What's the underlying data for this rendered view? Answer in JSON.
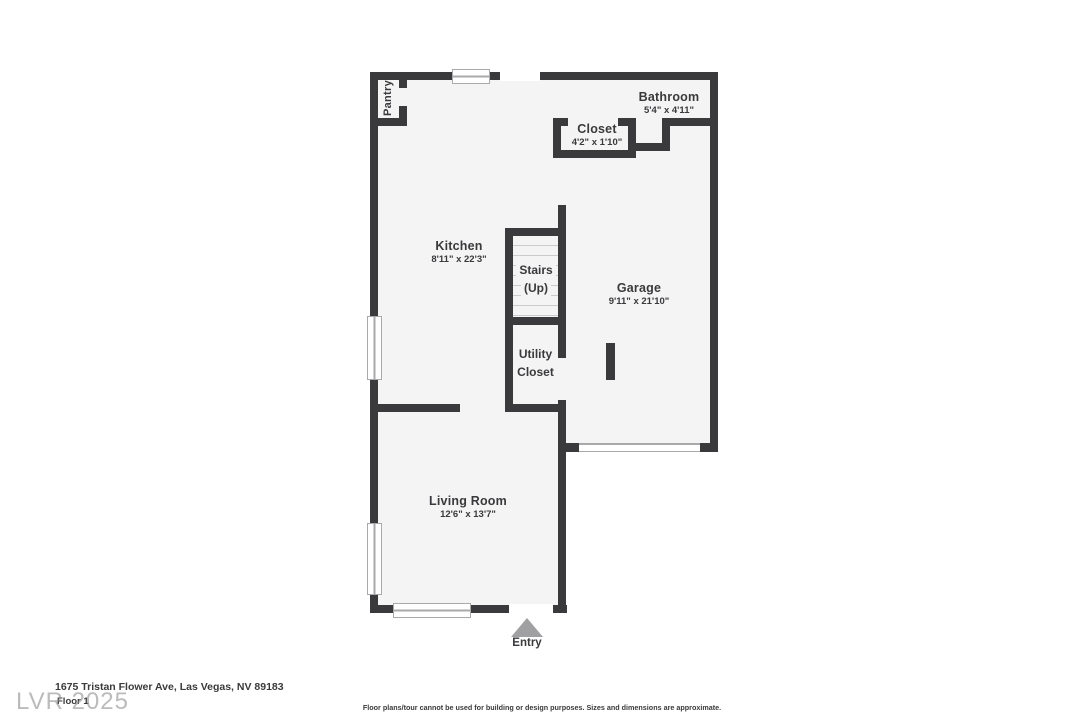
{
  "colors": {
    "wall": "#3a3a3c",
    "floor": "#f4f4f5",
    "text": "#3a3a3c",
    "tread": "#cbcbcd",
    "window_frame": "#a9a9ab",
    "entry_arrow": "#a0a0a2",
    "watermark": "#8e8e90"
  },
  "rooms": {
    "pantry": {
      "name": "Pantry"
    },
    "kitchen": {
      "name": "Kitchen",
      "dims": "8'11\" x 22'3\""
    },
    "bathroom": {
      "name": "Bathroom",
      "dims": "5'4\" x 4'11\""
    },
    "closet": {
      "name": "Closet",
      "dims": "4'2\" x 1'10\""
    },
    "stairs": {
      "line1": "Stairs",
      "line2": "(Up)"
    },
    "garage": {
      "name": "Garage",
      "dims": "9'11\" x 21'10\""
    },
    "utility": {
      "line1": "Utility",
      "line2": "Closet"
    },
    "living_room": {
      "name": "Living Room",
      "dims": "12'6\" x 13'7\""
    },
    "entry": {
      "label": "Entry"
    }
  },
  "footer": {
    "address": "1675 Tristan Flower Ave, Las Vegas, NV 89183",
    "floor_label": "Floor 1",
    "watermark": "LVR 2025",
    "disclaimer": "Floor plans/tour cannot be used for building or design purposes. Sizes and dimensions are approximate."
  }
}
